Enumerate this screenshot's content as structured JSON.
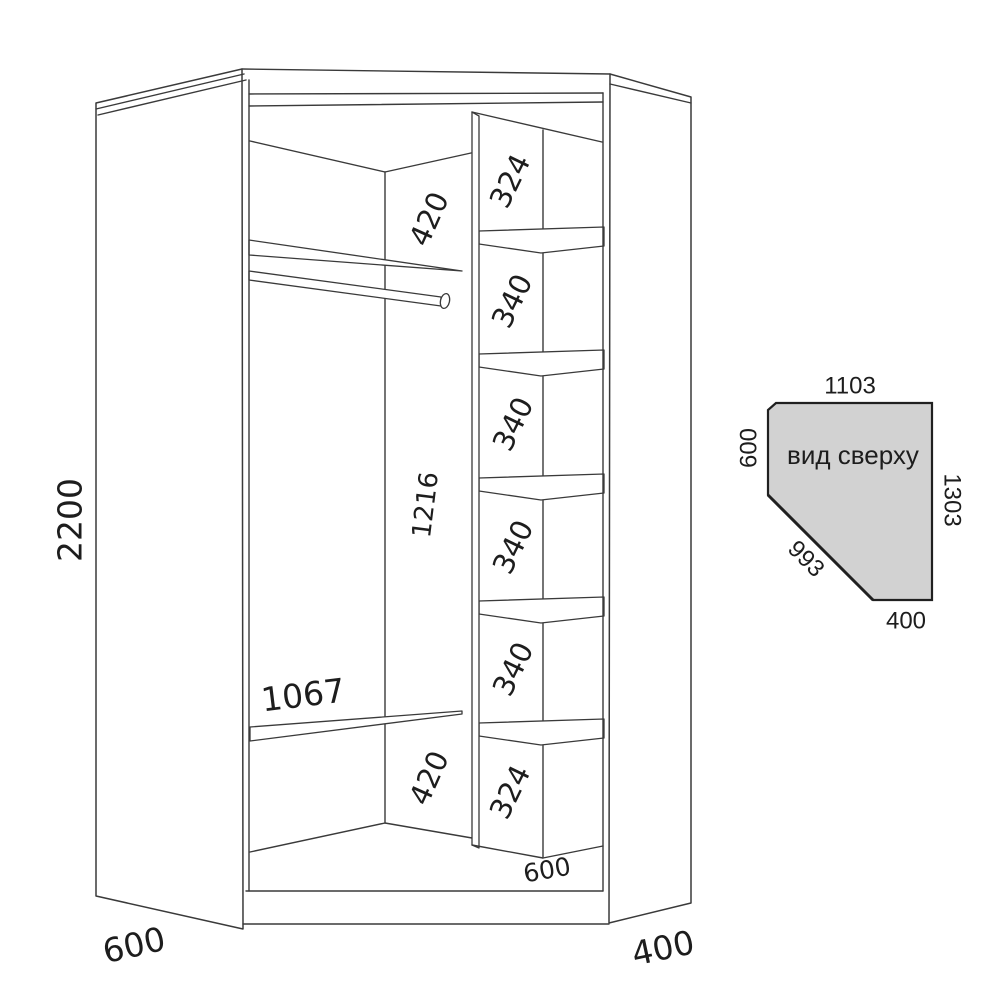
{
  "colors": {
    "line": "#3a3a3a",
    "text": "#1d1d1d",
    "top_view_fill": "#d2d2d2"
  },
  "front_view": {
    "overall_height": "2200",
    "left_depth": "600",
    "right_depth": "400",
    "left_section": {
      "top_gap": "420",
      "hang_height": "1216",
      "shelf_length": "1067",
      "bottom_gap": "420"
    },
    "shelf_column": {
      "top_cell": "324",
      "cells": [
        "340",
        "340",
        "340",
        "340"
      ],
      "bottom_cell": "324",
      "depth": "600"
    }
  },
  "top_view": {
    "title": "вид сверху",
    "top_width": "1103",
    "left_depth": "600",
    "right_depth": "1303",
    "front_diagonal": "993",
    "bottom_width": "400"
  }
}
